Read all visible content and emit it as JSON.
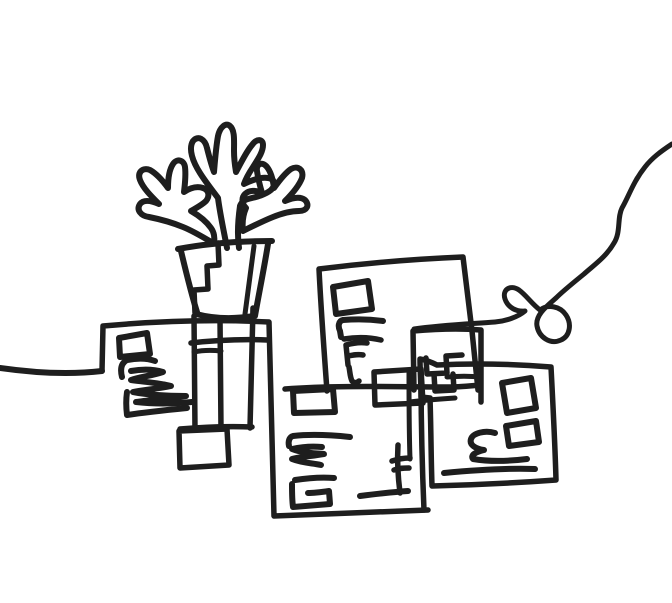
{
  "meta": {
    "description": "Black ink continuous-line doodle: a potted plant standing on overlapping wireframe cards, with a looping string curving in from the top-right edge"
  },
  "canvas": {
    "width": 672,
    "height": 603,
    "background": "#ffffff",
    "ink": "#1e1e1e",
    "default_stroke_width": 5.5
  },
  "strokes": [
    {
      "name": "entry-line-left",
      "w": 6,
      "d": "M0,368 C35,373 68,375 102,371"
    },
    {
      "name": "left-card-top-and-bottom-card-left",
      "w": 5.5,
      "d": "M102,371 L103,326 C158,321 213,319 269,322 C271,387 272,452 274,516 C325,514 377,512 428,510"
    },
    {
      "name": "left-card-right-edge",
      "w": 5.5,
      "d": "M253,308 C252,348 251,388 250,428"
    },
    {
      "name": "left-card-bottom-edge",
      "w": 5.5,
      "d": "M180,429 C204,427 228,426 252,427"
    },
    {
      "name": "column-foot-rect",
      "w": 5.5,
      "d": "M179,431 L227,429 L229,465 L180,468 Z"
    },
    {
      "name": "plant-column-left",
      "w": 5.5,
      "d": "M194,316 L195,430"
    },
    {
      "name": "plant-column-right",
      "w": 5.5,
      "d": "M220,318 L221,429"
    },
    {
      "name": "plant-column-rung",
      "w": 5,
      "d": "M194,352 C203,350 212,350 221,351"
    },
    {
      "name": "connector-line-mid",
      "w": 5.5,
      "d": "M191,343 C217,340 243,339 267,340"
    },
    {
      "name": "left-card-inner-rect",
      "w": 6,
      "d": "M119,338 L147,333 L150,354 L120,357 Z"
    },
    {
      "name": "left-card-scribble-top",
      "w": 6,
      "d": "M122,377 C120,369 121,363 127,360 C137,358 147,358 155,361"
    },
    {
      "name": "left-card-scribble-zigzag",
      "w": 6,
      "d": "M131,371 C142,369 153,369 163,372 C151,376 139,377 131,380 C145,382 160,383 171,386 C157,389 142,390 133,392 C149,395 168,396 186,396 C168,399 149,400 136,402 C153,404 172,404 192,402"
    },
    {
      "name": "left-card-scribble-hook",
      "w": 6,
      "d": "M127,392 C126,399 126,407 127,415 C147,412 167,410 187,408"
    },
    {
      "name": "pot-rim",
      "w": 6,
      "d": "M178,249 C209,243 241,241 272,241"
    },
    {
      "name": "pot-left-side",
      "w": 6,
      "d": "M181,251 C186,272 191,293 197,312"
    },
    {
      "name": "pot-right-side-outer",
      "w": 6,
      "d": "M268,244 C264,269 259,293 255,316"
    },
    {
      "name": "pot-right-side-inner",
      "w": 5,
      "d": "M254,246 C251,269 248,292 245,314"
    },
    {
      "name": "pot-base",
      "w": 6,
      "d": "M196,314 C215,319 235,319 254,316"
    },
    {
      "name": "pot-inner-staircase",
      "w": 5.5,
      "d": "M218,243 L219,265 L207,266 L208,289 L194,290 L195,313"
    },
    {
      "name": "leaf-center",
      "w": 6,
      "d": "M227,248 C224,232 220,214 218,198 C212,190 205,181 200,173 C193,162 188,149 193,141 C198,135 205,139 207,148 C209,156 211,164 214,172 C215,160 216,147 218,136 C220,127 226,122 230,126 C235,130 234,141 234,151 C234,159 235,166 236,172 C241,163 246,152 252,145 C257,138 263,139 263,145 C263,152 258,159 253,167 C249,173 246,178 244,184 C252,180 261,177 268,178 C275,179 276,185 271,190 C265,195 256,197 248,199 C244,200 241,203 240,206 C238,220 237,234 239,248"
    },
    {
      "name": "leaf-left",
      "w": 6,
      "d": "M213,243 C203,237 193,231 183,227 C171,222 159,219 149,217 C141,216 136,210 140,204 C144,199 152,201 159,204 C151,196 143,188 140,180 C137,172 143,167 150,170 C157,174 163,181 168,188 C168,179 169,170 173,164 C177,158 184,160 185,167 C186,175 185,184 184,192 C190,188 197,186 203,188 C209,190 210,196 206,201 C202,205 196,208 191,211 C198,215 206,221 211,228 C214,232 215,238 214,243"
    },
    {
      "name": "leaf-right",
      "w": 6,
      "d": "M243,231 C253,226 263,221 273,217 C283,213 292,211 299,211 C307,211 310,205 305,200 C300,196 292,198 285,201 C292,194 299,186 302,178 C304,170 298,165 291,169 C285,173 279,181 274,188 C273,180 271,172 267,167 C262,161 256,164 257,171 C258,178 260,186 262,193 C256,190 249,190 245,194 C241,198 242,204 246,208 C243,215 242,223 243,231"
    },
    {
      "name": "middle-card-outline",
      "w": 5.5,
      "d": "M327,391 C324,350 321,310 319,269 C367,263 415,259 463,257 C466,281 469,306 472,331 C474,351 476,371 478,390"
    },
    {
      "name": "middle-card-bottom-line",
      "w": 5.5,
      "d": "M285,389 C340,385 396,387 448,387 C459,387 470,386 480,385"
    },
    {
      "name": "middle-card-inner-rect",
      "w": 6,
      "d": "M333,287 L368,281 L372,309 L336,314 Z"
    },
    {
      "name": "middle-card-scribble-bar",
      "w": 6,
      "d": "M383,321 C369,319 355,319 343,320 C338,321 338,327 340,331 L341,337"
    },
    {
      "name": "middle-card-scribble-bar2",
      "w": 5.5,
      "d": "M344,339 C356,337 369,337 381,340"
    },
    {
      "name": "middle-card-scribble-f",
      "w": 5.5,
      "d": "M346,345 C353,343 360,342 367,343 M346,345 L348,365 M348,356 C353,355 358,354 363,355 M349,367 C350,372 350,377 352,381 C354,383 357,383 359,381"
    },
    {
      "name": "connector-rect-b",
      "w": 5.5,
      "d": "M375,405 L374,372 L421,369 L423,403 L376,405 Z"
    },
    {
      "name": "bottom-card-inner-vertical",
      "w": 5,
      "d": "M409,373 C409,402 409,431 410,459"
    },
    {
      "name": "bottom-card-right-edge",
      "w": 5.5,
      "d": "M421,370 C421,417 422,464 424,510"
    },
    {
      "name": "stair-rect",
      "w": 5.5,
      "d": "M414,390 L413,331 C436,329 458,328 481,330 L481,402"
    },
    {
      "name": "stair-step",
      "w": 5.5,
      "d": "M426,358 L427,374 L447,373 L446,356 L462,355"
    },
    {
      "name": "stair-notch",
      "w": 5.5,
      "d": "M434,374 L435,391 L454,390 L453,374"
    },
    {
      "name": "stair-bar",
      "w": 5,
      "d": "M447,377 C458,376 470,376 481,377"
    },
    {
      "name": "stair-lower-bar",
      "w": 5,
      "d": "M410,402 C425,400 440,399 455,398"
    },
    {
      "name": "bottom-card-inner-rect",
      "w": 6,
      "d": "M294,413 L293,391 L333,389 L335,412 Z"
    },
    {
      "name": "bottom-card-scribble-bar",
      "w": 6,
      "d": "M350,437 C331,435 311,434 293,436 C289,437 288,442 289,446"
    },
    {
      "name": "bottom-card-scribble-zigzag",
      "w": 6,
      "d": "M322,447 C312,446 301,447 292,449 C302,453 313,453 324,454 C312,456 300,457 292,459 C302,463 312,463 321,465"
    },
    {
      "name": "bottom-card-scribble-spiral",
      "w": 6,
      "d": "M295,480 C308,478 321,477 334,478 M292,484 C292,492 292,500 293,507 C306,506 318,505 330,504 L329,491 C322,492 315,493 308,493"
    },
    {
      "name": "bottom-card-scribble-f",
      "w": 5.5,
      "d": "M398,445 C397,461 398,477 400,493 M392,461 C398,459 404,458 410,458 M394,470 C399,468 404,468 409,468"
    },
    {
      "name": "bottom-card-scribble-underbar",
      "w": 6,
      "d": "M360,496 C376,494 392,492 408,491"
    },
    {
      "name": "right-card-outline",
      "w": 5.5,
      "d": "M437,365 C475,363 513,364 551,367 C553,405 555,443 556,480 C515,483 473,485 432,486 C431,457 431,427 430,398 L421,397 C421,384 420,371 420,359 C426,360 431,362 437,365"
    },
    {
      "name": "right-card-inner-rect-big",
      "w": 6,
      "d": "M502,383 L531,378 L536,408 L507,413 Z"
    },
    {
      "name": "right-card-inner-rect-small",
      "w": 6,
      "d": "M506,426 L536,421 L539,442 L509,446 Z"
    },
    {
      "name": "right-card-s-scribble",
      "w": 6,
      "d": "M495,433 C485,430 473,433 471,439 C469,445 476,449 484,450 C476,452 470,455 473,459 C491,462 511,461 527,459"
    },
    {
      "name": "right-card-underline",
      "w": 6,
      "d": "M444,473 C475,470 505,468 535,469"
    },
    {
      "name": "string-squiggle-with-loops",
      "w": 5,
      "d": "M672,144 C660,152 652,158 645,167 C633,182 629,196 622,208 C617,218 621,232 614,243 C606,257 594,265 584,274 C573,283 563,291 556,298 C547,306 535,315 537,326 C539,337 550,345 561,340 C570,336 572,324 566,315 C560,306 548,304 540,310 C532,304 526,295 519,290 C510,284 502,290 505,299 C508,308 517,312 525,311 C518,317 506,321 495,322 C468,324 441,325 414,329"
    }
  ]
}
